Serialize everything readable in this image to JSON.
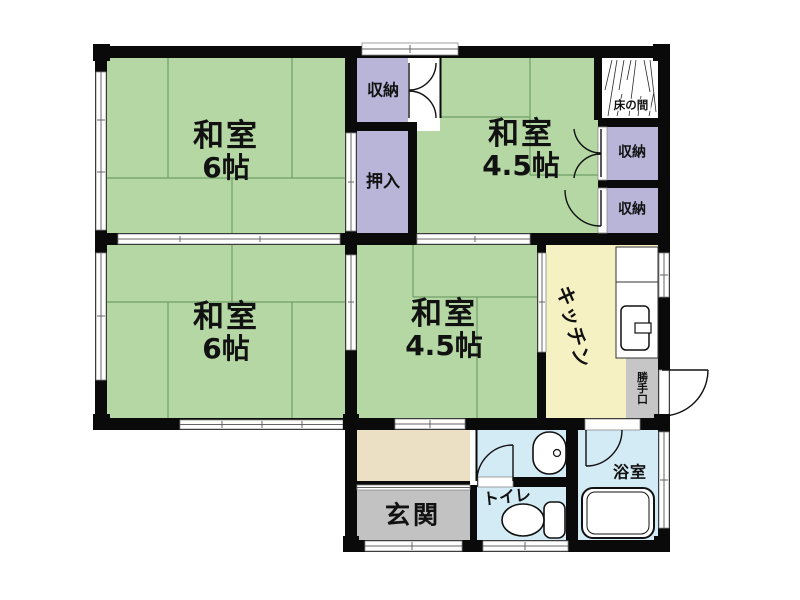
{
  "rooms": {
    "washitsu_6_top": {
      "name": "和室",
      "size": "6帖"
    },
    "washitsu_45_top": {
      "name": "和室",
      "size": "4.5帖"
    },
    "washitsu_6_mid": {
      "name": "和室",
      "size": "6帖"
    },
    "washitsu_45_mid": {
      "name": "和室",
      "size": "4.5帖"
    },
    "kitchen": {
      "name": "キッチン"
    },
    "genkan": {
      "name": "玄関"
    },
    "toilet": {
      "name": "トイレ"
    },
    "bathroom": {
      "name": "浴室"
    },
    "tokonoma": {
      "name": "床の間"
    },
    "oshiire": {
      "name": "押入"
    },
    "shuno_top": {
      "name": "収納"
    },
    "shuno_right_upper": {
      "name": "収納"
    },
    "shuno_right_lower": {
      "name": "収納"
    },
    "katteguchi": {
      "name": "勝手口"
    }
  },
  "colors": {
    "tatami_green": "#b4d7a4",
    "closet_purple": "#b9b5d8",
    "kitchen_yellow": "#f6f1c3",
    "hall_beige": "#ebdfc4",
    "genkan_gray": "#c2c2c2",
    "katteguchi_gray": "#c6c6c6",
    "water_blue": "#d3ebf5",
    "wall_black": "#0a0a0a",
    "tatami_line": "#6f9e68"
  }
}
